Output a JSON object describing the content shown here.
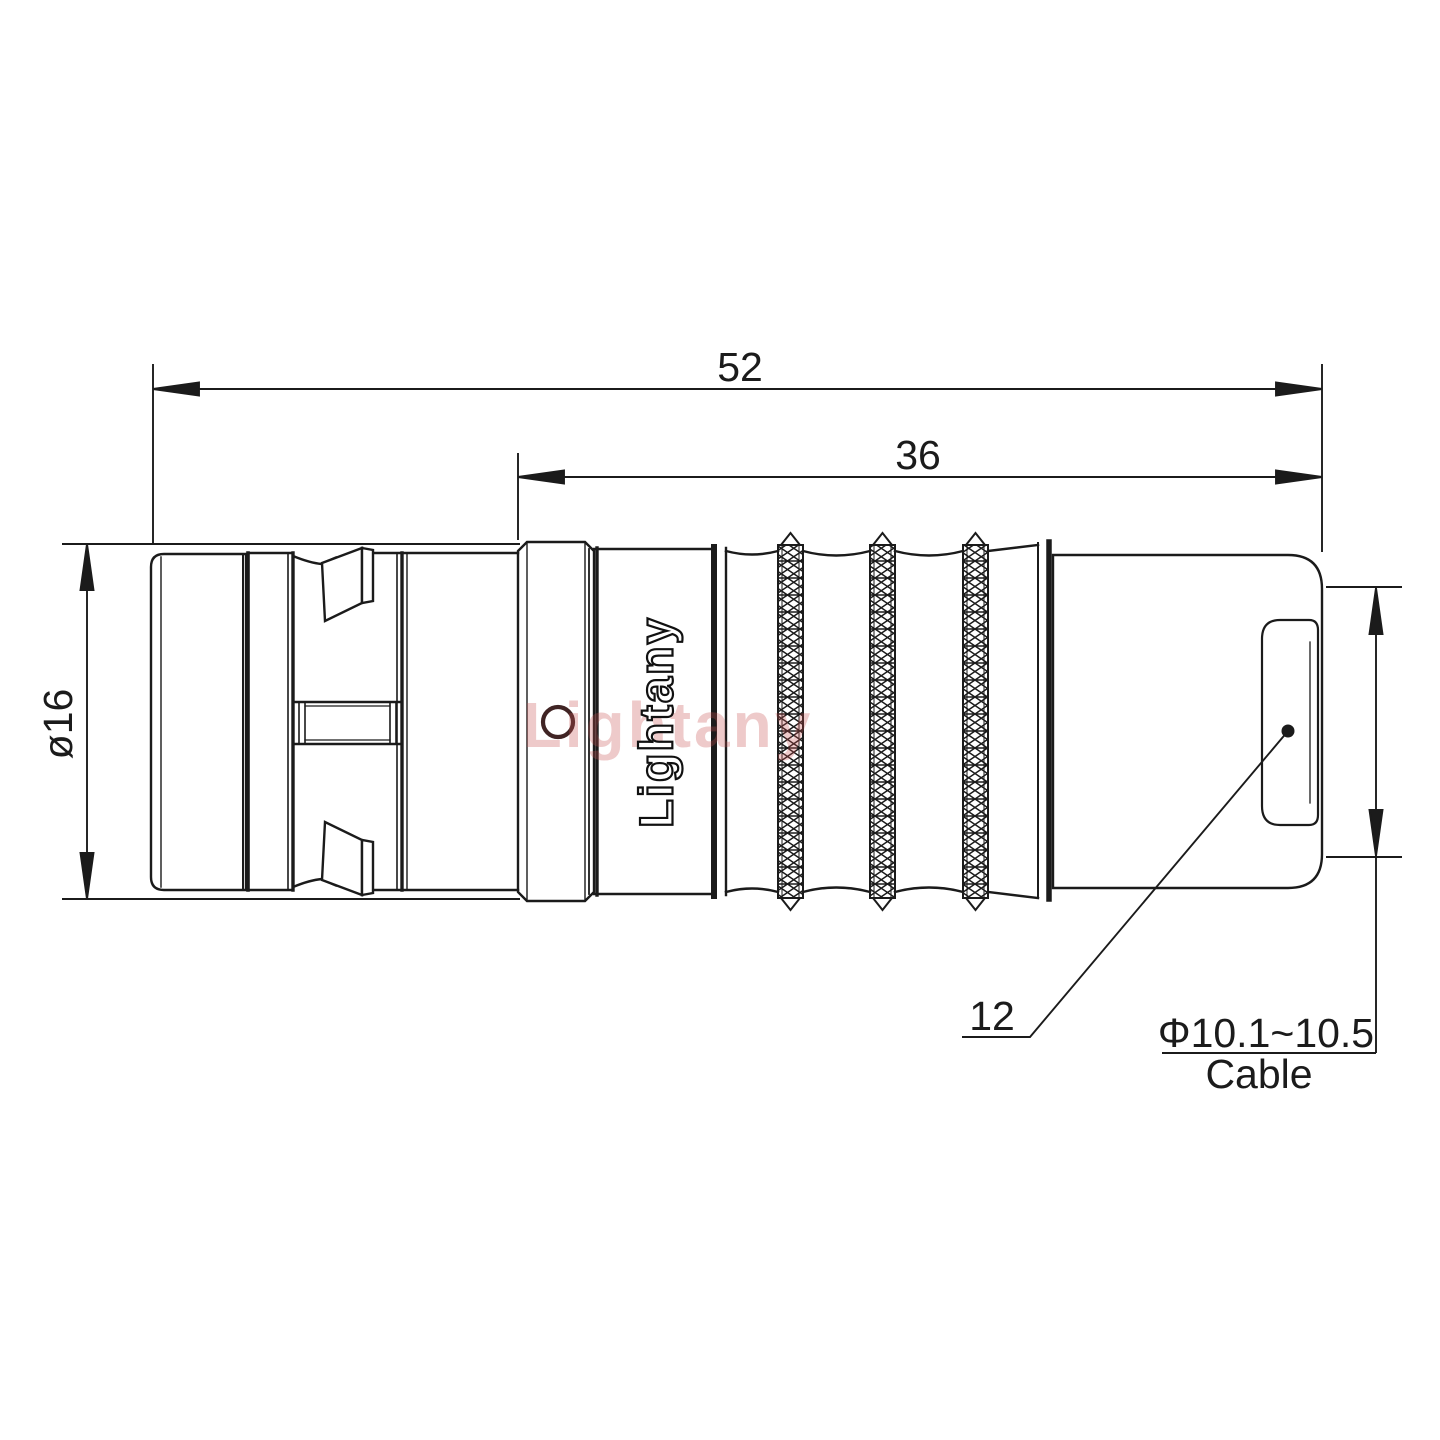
{
  "drawing": {
    "dimensions": {
      "overall_length": "52",
      "rear_section_length": "36",
      "body_diameter": "ø16",
      "rear_face_diameter": "12",
      "cable_diameter_range": "Φ10.1~10.5",
      "cable_word": "Cable"
    },
    "branding": {
      "logo": "Lightany",
      "watermark": "Lightany"
    },
    "colors": {
      "line": "#1b1b1b",
      "watermark": "#c65050",
      "logo_fill": "#ffffff",
      "background": "#ffffff"
    }
  }
}
